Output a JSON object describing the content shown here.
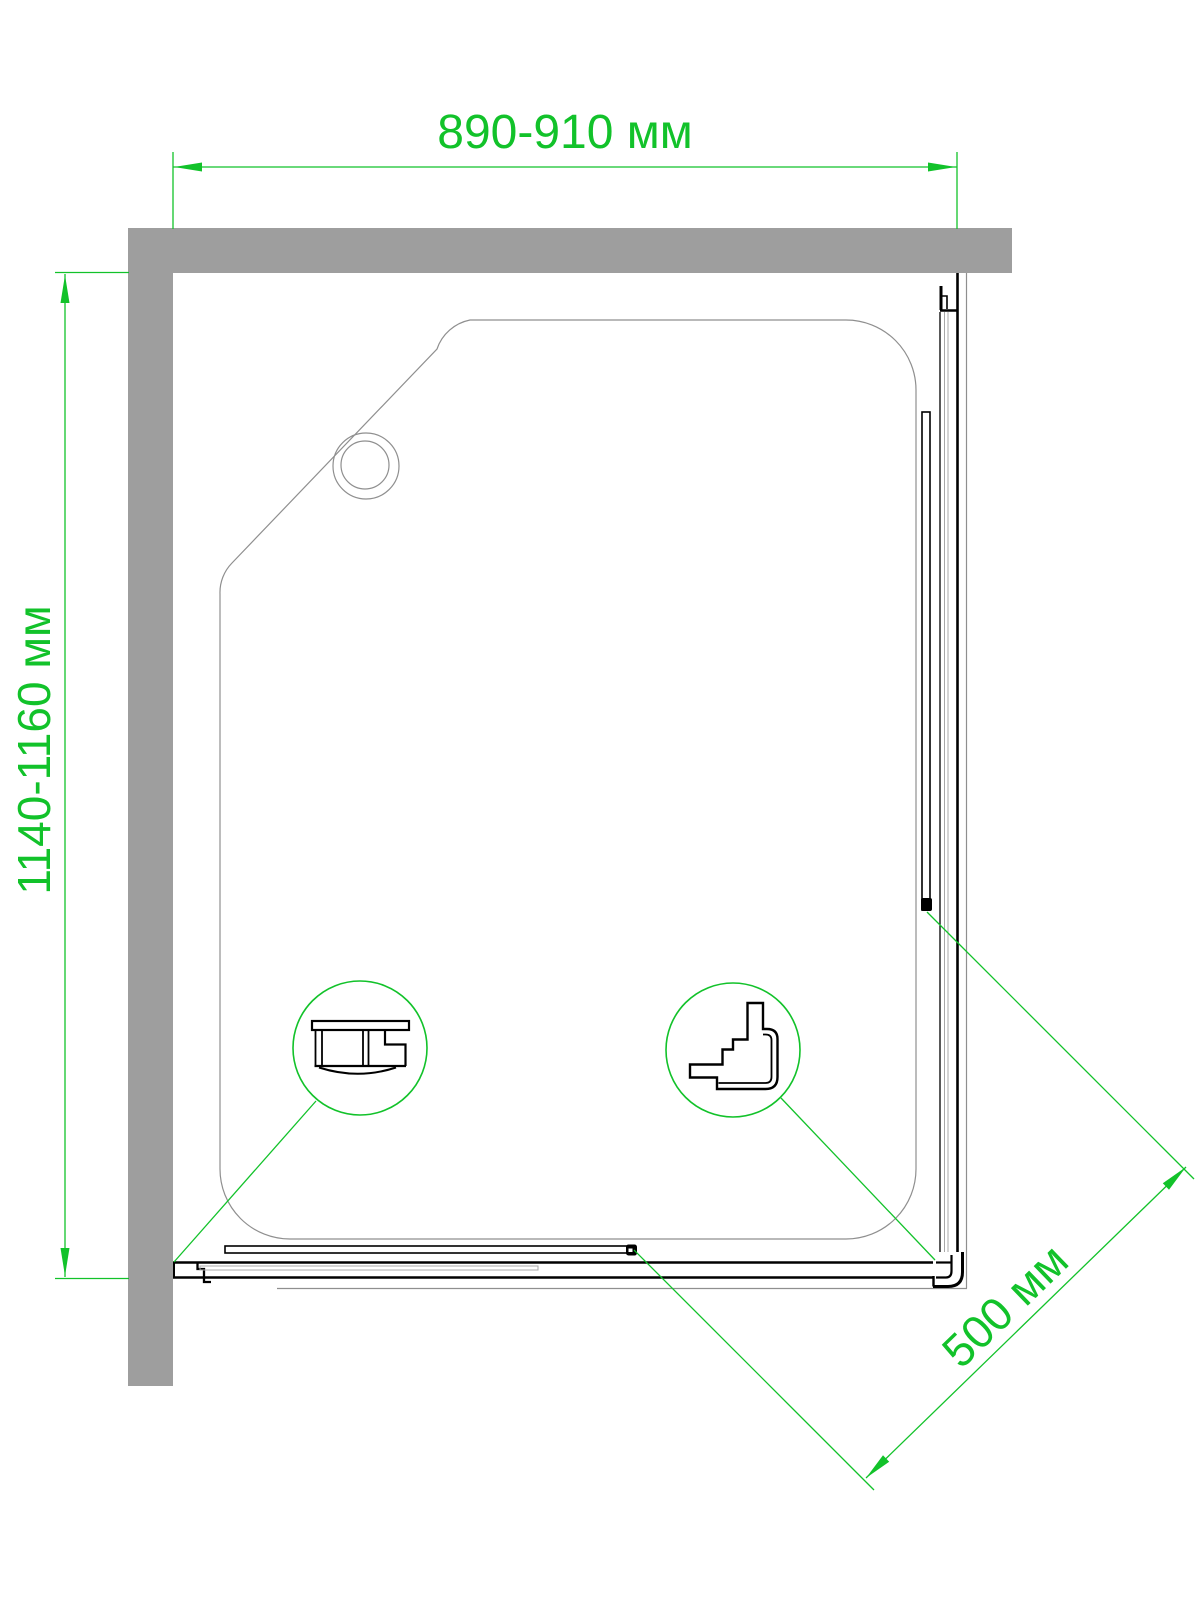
{
  "drawing": {
    "dimensions": {
      "width": {
        "label": "890-910 мм"
      },
      "depth": {
        "label": "1140-1160 мм"
      },
      "opening": {
        "label": "500 мм"
      }
    },
    "colors": {
      "dimension-green": "#12c22a",
      "wall-gray": "#9e9e9e",
      "outline-gray": "#8f8f8f",
      "inner-gray": "#a8a8a8",
      "profile-black": "#000000"
    }
  }
}
